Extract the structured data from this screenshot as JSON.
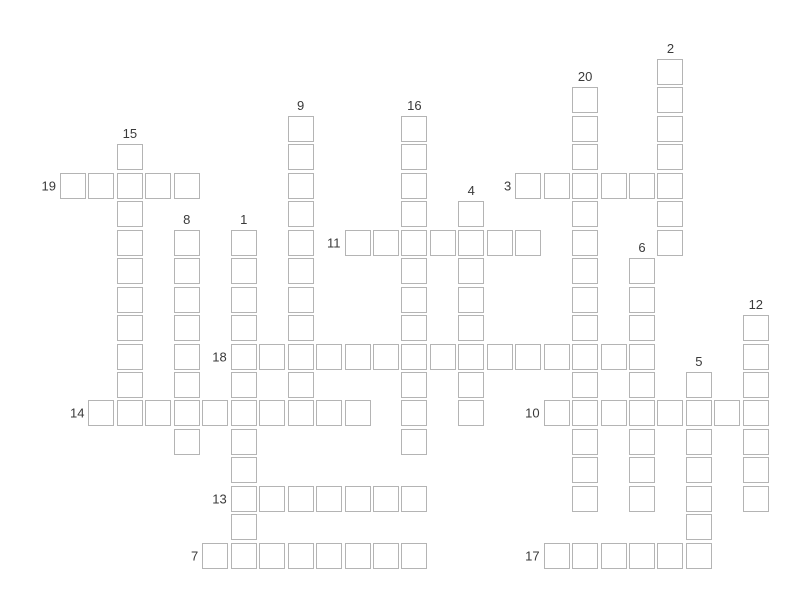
{
  "app": {
    "background_color": "#ffffff"
  },
  "puzzle": {
    "type": "crossword",
    "state": "empty",
    "cell_fill_color": "#ffffff",
    "cell_border_color": "#b4b4b4",
    "number_color": "#3a3a3a",
    "words": [
      {
        "number": 1,
        "direction": "down",
        "row": 6,
        "col": 6,
        "length": 12
      },
      {
        "number": 2,
        "direction": "down",
        "row": 0,
        "col": 21,
        "length": 7
      },
      {
        "number": 3,
        "direction": "across",
        "row": 4,
        "col": 16,
        "length": 6
      },
      {
        "number": 4,
        "direction": "down",
        "row": 5,
        "col": 14,
        "length": 8
      },
      {
        "number": 5,
        "direction": "down",
        "row": 11,
        "col": 22,
        "length": 7
      },
      {
        "number": 6,
        "direction": "down",
        "row": 7,
        "col": 20,
        "length": 9
      },
      {
        "number": 7,
        "direction": "across",
        "row": 17,
        "col": 5,
        "length": 8
      },
      {
        "number": 8,
        "direction": "down",
        "row": 6,
        "col": 4,
        "length": 8
      },
      {
        "number": 9,
        "direction": "down",
        "row": 2,
        "col": 8,
        "length": 11
      },
      {
        "number": 10,
        "direction": "across",
        "row": 12,
        "col": 17,
        "length": 8
      },
      {
        "number": 11,
        "direction": "across",
        "row": 6,
        "col": 10,
        "length": 7
      },
      {
        "number": 12,
        "direction": "down",
        "row": 9,
        "col": 24,
        "length": 7
      },
      {
        "number": 13,
        "direction": "across",
        "row": 15,
        "col": 6,
        "length": 7
      },
      {
        "number": 14,
        "direction": "across",
        "row": 12,
        "col": 1,
        "length": 10
      },
      {
        "number": 15,
        "direction": "down",
        "row": 3,
        "col": 2,
        "length": 10
      },
      {
        "number": 16,
        "direction": "down",
        "row": 2,
        "col": 12,
        "length": 12
      },
      {
        "number": 17,
        "direction": "across",
        "row": 17,
        "col": 17,
        "length": 6
      },
      {
        "number": 18,
        "direction": "across",
        "row": 10,
        "col": 6,
        "length": 15
      },
      {
        "number": 19,
        "direction": "across",
        "row": 4,
        "col": 0,
        "length": 5
      },
      {
        "number": 20,
        "direction": "down",
        "row": 1,
        "col": 18,
        "length": 15
      }
    ]
  }
}
